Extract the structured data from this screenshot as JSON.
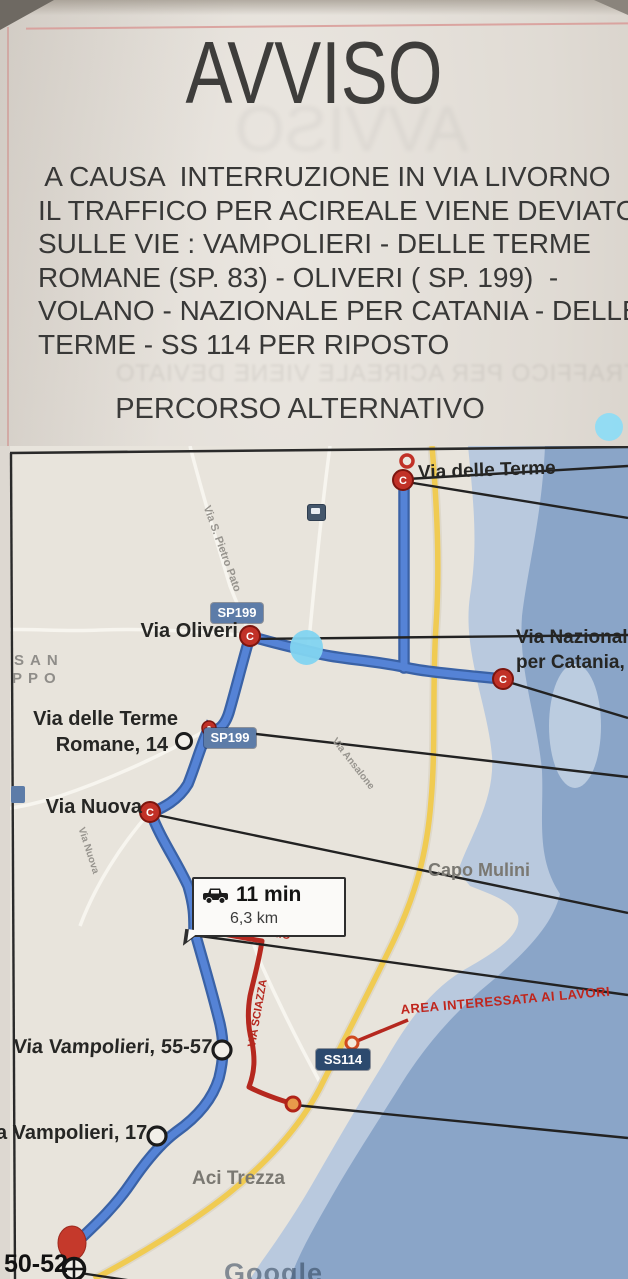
{
  "notice": {
    "title": "AVVISO",
    "body_lines": [
      " A CAUSA  INTERRUZIONE IN VIA LIVORNO",
      "IL TRAFFICO PER ACIREALE VIENE DEVIATO",
      "SULLE VIE : VAMPOLIERI - DELLE TERME",
      "ROMANE (SP. 83) - OLIVERI ( SP. 199)  -",
      "VOLANO - NAZIONALE PER CATANIA - DELLE",
      "TERME - SS 114 PER RIPOSTO",
      "PERCORSO ALTERNATIVO"
    ],
    "subtitle": "PERCORSO ALTERNATIVO",
    "bleed_title": "AVVISO",
    "bleed_line": "IL TRAFFICO PER ACIREALE VIENE DEVIATO"
  },
  "map": {
    "region": {
      "line1": "SAN",
      "line2": "PPO"
    },
    "shields": {
      "sp199": "SP199",
      "ss114": "SS114"
    },
    "marker_letter": "C",
    "stops": {
      "terme": "Via delle Terme",
      "oliveri": "Via Oliveri",
      "nazionale1": "Via Nazionale",
      "nazionale2": "per Catania, 104",
      "terme_romane1": "Via delle Terme",
      "terme_romane2": "Romane, 14",
      "nuova": "Via Nuova",
      "vampolieri55": "Via Vampolieri, 55-57",
      "vampolieri17": "a Vampolieri, 17",
      "dest": "50-52"
    },
    "places": {
      "capo_mulini": "Capo Mulini",
      "aci_trezza": "Aci Trezza"
    },
    "streets": {
      "s_pietro": "Via S. Pietro Pato",
      "ansalone": "Via Ansalone",
      "nuova_diag": "Via Nuova",
      "sciazza": "VIA SCIAZZA",
      "dello_ionio": "VIA DELLO IONIO"
    },
    "route_info": {
      "duration": "11 min",
      "distance": "6,3 km"
    },
    "warning": "AREA INTERESSATA AI LAVORI",
    "watermark": "Google"
  },
  "colors": {
    "route_blue": "#5583d6",
    "road_yellow": "#f0cb52",
    "detour_red": "#b5281f",
    "sea": "#8aa5c8",
    "marker_red": "#c13127",
    "cyan_dot": "#7fd3ef",
    "shield_blue": "#5d7ca8",
    "shield_navy": "#2c4a6e"
  }
}
